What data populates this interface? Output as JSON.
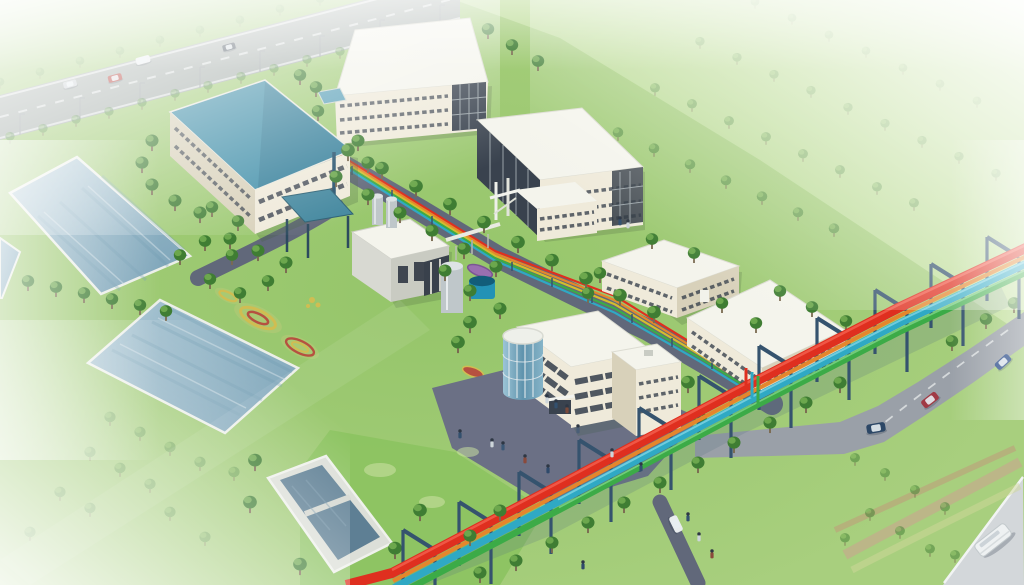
{
  "image": {
    "kind": "3d-aerial-architectural-rendering",
    "subject": "industrial campus with ponds, white buildings and a colored elevated utility pipe rack",
    "visible_text": ""
  },
  "colors": {
    "grass_base": "#a8cf7e",
    "grass_bright": "#85bd58",
    "field_green": "#c8e2a4",
    "lawn_bright": "#8cc360",
    "lawn_patch": "#c8e0a0",
    "pond_water": "#8fb3c6",
    "pond_rim": "#ecefe9",
    "basin_water": "#5e7f94",
    "concrete": "#dcdfd8",
    "asphalt_dark": "#61687a",
    "plaza_gray": "#6b7085",
    "ring_road": "#9aa0a8",
    "outer_road": "#d3d7da",
    "highway_gray": "#a4aaae",
    "roof_white": "#f4f4ec",
    "wall_cream": "#efeada",
    "wall_shade": "#d8d1ba",
    "wall_gray": "#d8d9d2",
    "window_dark": "#39424e",
    "roof_teal": "#418fa9",
    "roof_teal_dark": "#2d7590",
    "canopy_teal": "#44889f",
    "glass_blue": "#7fb3c9",
    "pipe_red": "#df2f1f",
    "pipe_orange": "#e5862c",
    "pipe_yellow": "#d3bc2e",
    "pipe_cyan": "#2fa9c4",
    "pipe_green": "#3cab47",
    "pipe_support": "#35536e",
    "tree_dark": "#3f7d33",
    "tree_light": "#74ae52",
    "tank_silver": "#bfc7ca",
    "tank_blue": "#2392b6",
    "tank_blue_dark": "#125d7a",
    "flower_yellow": "#d0bd52",
    "flower_red": "#b65140",
    "flower_purple": "#9a6fb0",
    "flower_pink_strip": "#cf9d92",
    "haze_white": "#ffffff"
  },
  "pipe_rack": {
    "pipe_colors_top_to_bottom": [
      "red",
      "orange",
      "cyan",
      "green"
    ]
  },
  "branch_pipes": {
    "colors": [
      "red",
      "orange",
      "yellow",
      "green",
      "cyan"
    ]
  },
  "site": {
    "water_ponds": 2,
    "pond_fragments": 1,
    "settling_basin": 1,
    "buildings": [
      "blue-roof-workshop",
      "north-three-story-block",
      "central-three-story-block",
      "two-story-workshop-a",
      "two-story-workshop-b",
      "process-plant",
      "admin-building-with-glass-rotunda"
    ],
    "tanks": [
      "silver-silo-pair",
      "large-silver-tank",
      "blue-water-tank"
    ],
    "canopy": "teal-shade-canopy",
    "flower_gardens": 5
  },
  "vehicles": {
    "highway_cars": 4,
    "ring_road_cars": 3,
    "campus_cars": 1,
    "buses": 1
  }
}
